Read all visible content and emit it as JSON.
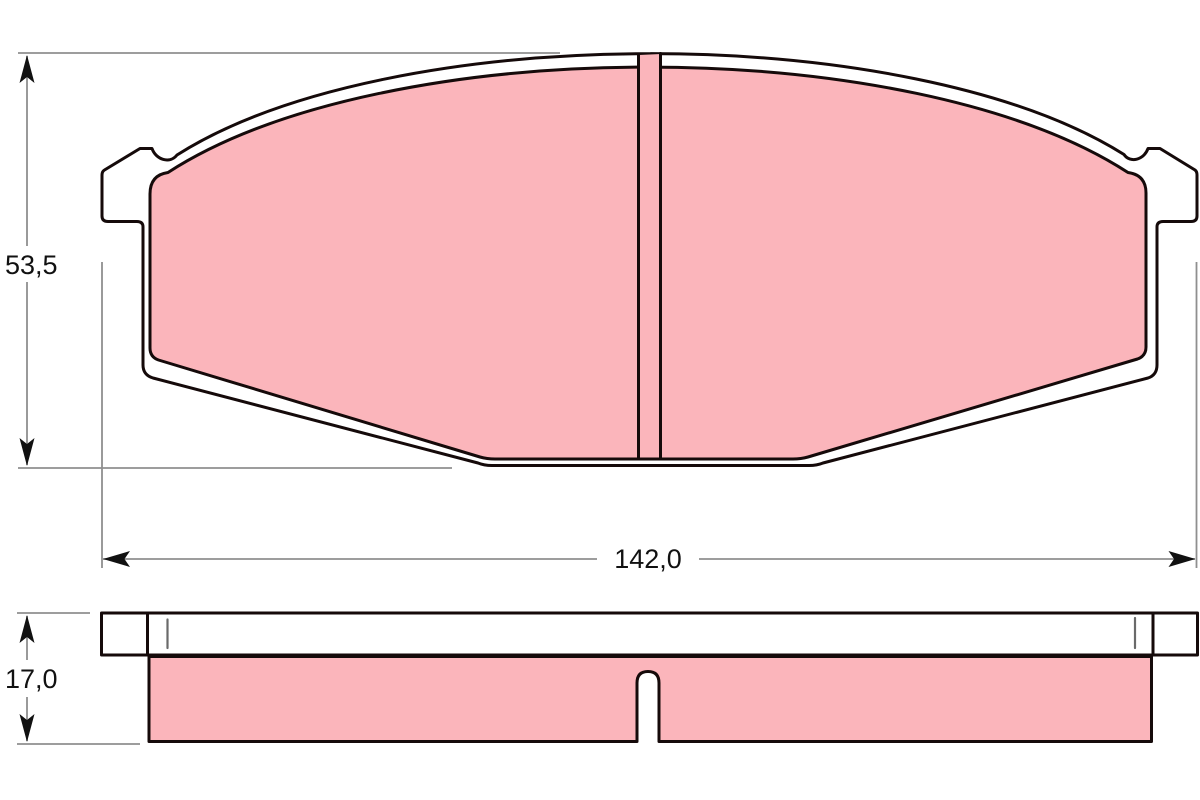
{
  "dimensions": {
    "height": {
      "label": "53,5"
    },
    "width": {
      "label": "142,0"
    },
    "thickness": {
      "label": "17,0"
    }
  },
  "colors": {
    "friction_material": "#fbb5bb",
    "outline": "#150a0a",
    "dimension_line": "#8f8f8f",
    "text": "#111111",
    "background": "#ffffff"
  }
}
